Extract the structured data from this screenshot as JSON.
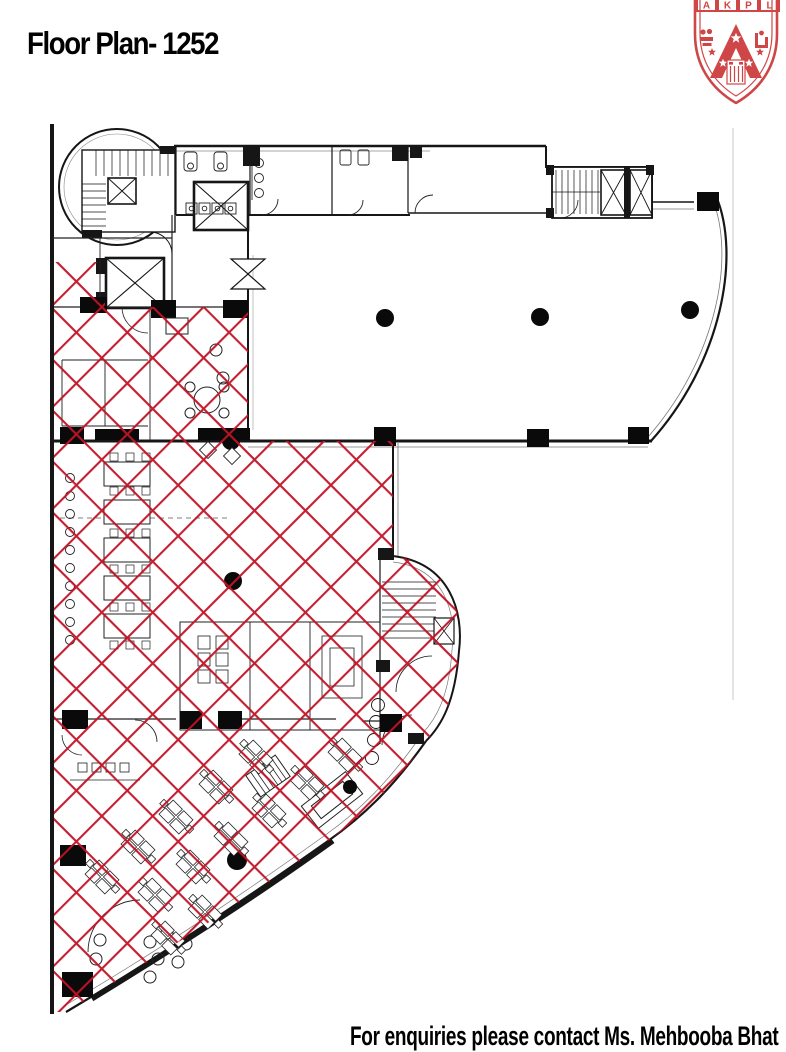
{
  "page": {
    "title": "Floor Plan- 1252",
    "contact_note": "For enquiries please contact Ms. Mehbooba Bhat"
  },
  "crest": {
    "letters": [
      "A",
      "K",
      "P",
      "L"
    ]
  },
  "colors": {
    "hatch_red": "#c11226",
    "crest_red": "#cf4646",
    "ink": "#161616"
  },
  "plan": {
    "hatched_area_meaning": "red cross-hatched floor area",
    "floor_number": "1252"
  }
}
